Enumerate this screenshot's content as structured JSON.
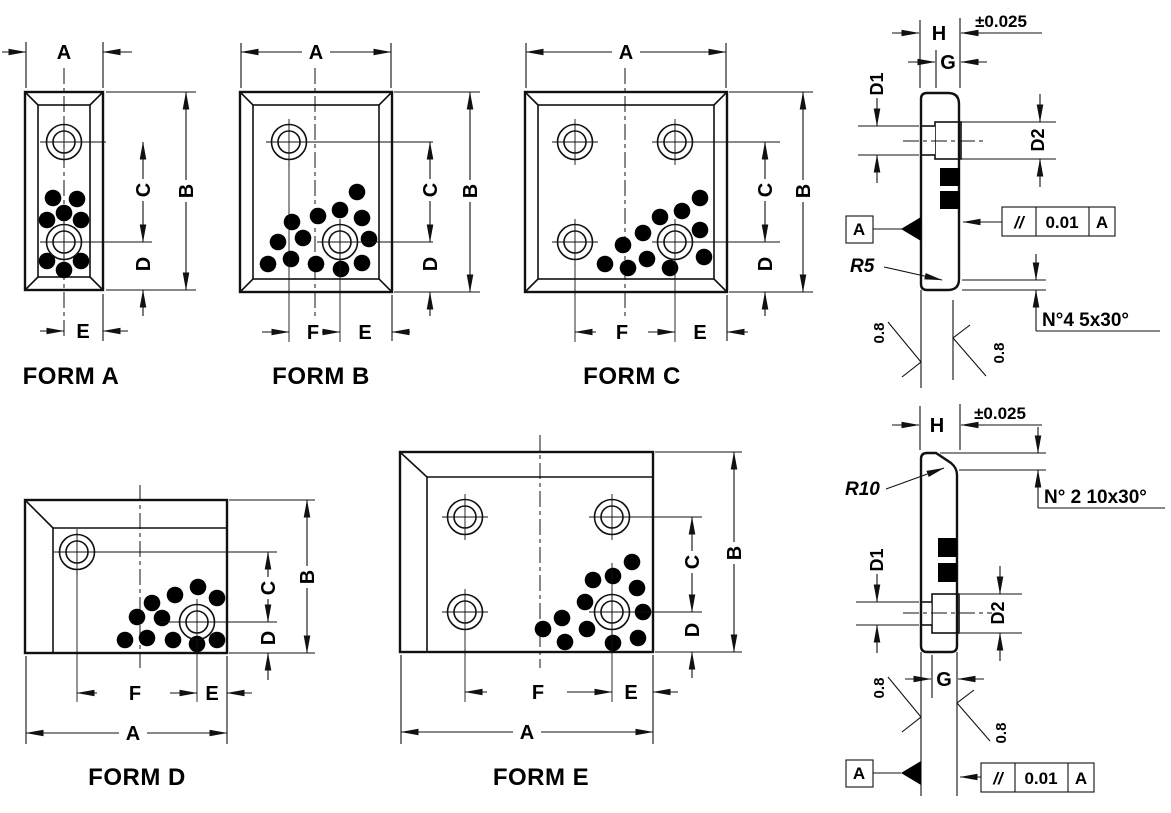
{
  "drawing": {
    "dim_labels": {
      "A": "A",
      "B": "B",
      "C": "C",
      "D": "D",
      "E": "E",
      "F": "F",
      "G": "G",
      "H": "H",
      "D1": "D1",
      "D2": "D2"
    },
    "forms": {
      "a": {
        "label": "FORM A"
      },
      "b": {
        "label": "FORM B"
      },
      "c": {
        "label": "FORM C"
      },
      "d": {
        "label": "FORM D"
      },
      "e": {
        "label": "FORM E"
      }
    },
    "sections": {
      "top": {
        "thickness_tolerance": "±0.025",
        "corner_radius": "R5",
        "chamfer_note": "N°4  5x30°",
        "surface_roughness": "0.8",
        "datum_label": "A",
        "parallelism": {
          "symbol": "//",
          "value": "0.01",
          "datum": "A"
        }
      },
      "bottom": {
        "thickness_tolerance": "±0.025",
        "corner_radius": "R10",
        "chamfer_note": "N° 2  10x30°",
        "surface_roughness": "0.8",
        "datum_label": "A",
        "parallelism": {
          "symbol": "//",
          "value": "0.01",
          "datum": "A"
        }
      }
    }
  }
}
